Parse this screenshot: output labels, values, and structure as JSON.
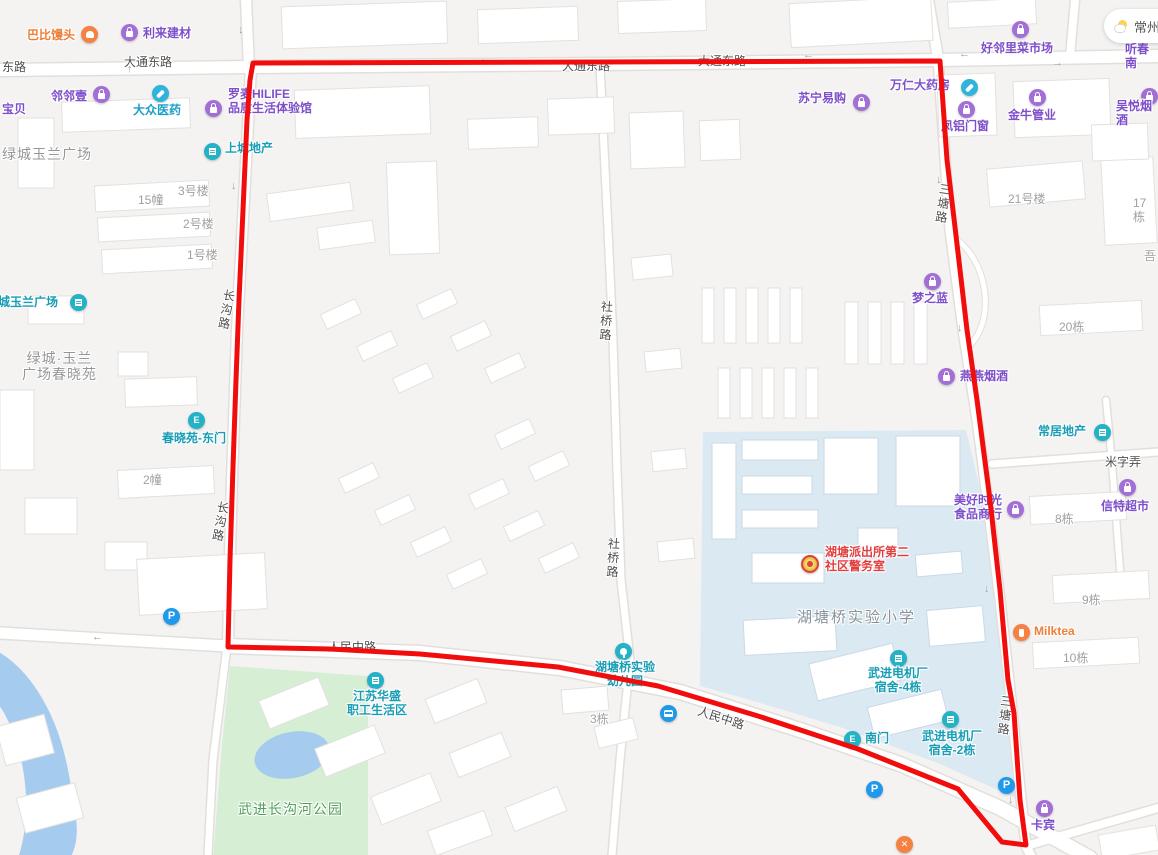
{
  "map": {
    "weather": {
      "city": "常州",
      "icon": "partly-sunny-icon"
    },
    "selection": {
      "color": "#f20d0d",
      "width": 5,
      "points": "253,63 940,61 947,160 955,227 962,287 967,330 977,400 990,500 1000,590 1008,680 1014,713 1020,800 1026,845 1002,842 958,789 858,749 758,716 658,686 558,667 420,654 330,649 228,647 230,560 233,467 236,380 239,300 243,210 247,120 250,80 253,63"
    },
    "road_labels": [
      {
        "text": "东路",
        "x": 2,
        "y": 61
      },
      {
        "text": "大通东路",
        "x": 124,
        "y": 56
      },
      {
        "text": "大通东路",
        "x": 562,
        "y": 60
      },
      {
        "text": "大通东路",
        "x": 698,
        "y": 55
      },
      {
        "text": "长沟路",
        "x": 222,
        "y": 288,
        "vertical": true,
        "rotate": 10
      },
      {
        "text": "长沟路",
        "x": 216,
        "y": 500,
        "vertical": true,
        "rotate": 10
      },
      {
        "text": "社桥路",
        "x": 599,
        "y": 300,
        "vertical": true,
        "rotate": 3
      },
      {
        "text": "社桥路",
        "x": 606,
        "y": 537,
        "vertical": true,
        "rotate": 3
      },
      {
        "text": "三塘路",
        "x": 938,
        "y": 182,
        "vertical": true,
        "rotate": 8
      },
      {
        "text": "三塘路",
        "x": 999,
        "y": 694,
        "vertical": true,
        "rotate": 6
      },
      {
        "text": "人民中路",
        "x": 328,
        "y": 641
      },
      {
        "text": "人民中路",
        "x": 700,
        "y": 705,
        "rotate": 18
      },
      {
        "text": "米字弄",
        "x": 1105,
        "y": 456
      }
    ],
    "unit_labels": [
      {
        "text": "15幢",
        "x": 138,
        "y": 194
      },
      {
        "text": "3号楼",
        "x": 178,
        "y": 185
      },
      {
        "text": "2号楼",
        "x": 183,
        "y": 218
      },
      {
        "text": "1号楼",
        "x": 187,
        "y": 249
      },
      {
        "text": "2幢",
        "x": 143,
        "y": 474
      },
      {
        "text": "3栋",
        "x": 590,
        "y": 713
      },
      {
        "text": "21号楼",
        "x": 1008,
        "y": 193
      },
      {
        "text": "17栋",
        "x": 1133,
        "y": 197
      },
      {
        "text": "吾",
        "x": 1144,
        "y": 250
      },
      {
        "text": "20栋",
        "x": 1059,
        "y": 321
      },
      {
        "text": "8栋",
        "x": 1055,
        "y": 513
      },
      {
        "text": "9栋",
        "x": 1082,
        "y": 594
      },
      {
        "text": "10栋",
        "x": 1063,
        "y": 652
      }
    ],
    "area_labels": [
      {
        "text": "绿城玉兰广场",
        "x": 2,
        "y": 146,
        "cls": "aoi"
      },
      {
        "text": "绿城·玉兰\n广场春晓苑",
        "x": 22,
        "y": 350,
        "cls": "aoi"
      },
      {
        "text": "湖塘桥实验小学",
        "x": 797,
        "y": 609,
        "cls": "school-name"
      },
      {
        "text": "武进长沟河公园",
        "x": 238,
        "y": 801,
        "cls": "park-name"
      }
    ],
    "pois": [
      {
        "text": "巴比馒头",
        "x": 27,
        "y": 29,
        "color": "orange",
        "icon": {
          "type": "bun",
          "bg": "orange",
          "x": 81,
          "y": 26
        }
      },
      {
        "text": "利来建材",
        "x": 143,
        "y": 27,
        "color": "purple",
        "icon": {
          "type": "bag",
          "bg": "purple",
          "x": 121,
          "y": 24
        }
      },
      {
        "text": "宝贝",
        "x": 2,
        "y": 103,
        "color": "purple"
      },
      {
        "text": "邻邻壹",
        "x": 51,
        "y": 90,
        "color": "purple",
        "icon": {
          "type": "bag",
          "bg": "purple",
          "x": 93,
          "y": 86
        }
      },
      {
        "text": "大众医药",
        "x": 133,
        "y": 104,
        "color": "cyan",
        "icon": {
          "type": "pill",
          "bg": "cyan",
          "x": 152,
          "y": 85
        }
      },
      {
        "text": "罗麦HILIFE\n品质生活体验馆",
        "x": 228,
        "y": 88,
        "color": "purple",
        "icon": {
          "type": "bag",
          "bg": "purple",
          "x": 205,
          "y": 100
        }
      },
      {
        "text": "上城地产",
        "x": 225,
        "y": 142,
        "color": "teal",
        "icon": {
          "type": "bldg",
          "bg": "teal",
          "x": 204,
          "y": 143
        }
      },
      {
        "text": "绿城玉兰广场",
        "x": -14,
        "y": 296,
        "color": "teal",
        "icon": {
          "type": "bldg",
          "bg": "teal",
          "x": 70,
          "y": 294
        }
      },
      {
        "text": "春晓苑-东门",
        "x": 162,
        "y": 432,
        "color": "teal",
        "icon": {
          "type": "door",
          "bg": "teal",
          "x": 188,
          "y": 412
        }
      },
      {
        "text": "苏宁易购",
        "x": 798,
        "y": 92,
        "color": "purple",
        "icon": {
          "type": "bag",
          "bg": "purple",
          "x": 853,
          "y": 94
        }
      },
      {
        "text": "万仁大药房",
        "x": 890,
        "y": 79,
        "color": "purple",
        "icon": {
          "type": "pill",
          "bg": "cyan",
          "x": 961,
          "y": 79
        }
      },
      {
        "text": "凤铝门窗",
        "x": 941,
        "y": 120,
        "color": "purple",
        "icon": {
          "type": "bag",
          "bg": "purple",
          "x": 958,
          "y": 101
        }
      },
      {
        "text": "金牛管业",
        "x": 1008,
        "y": 109,
        "color": "purple",
        "icon": {
          "type": "bag",
          "bg": "purple",
          "x": 1029,
          "y": 89
        }
      },
      {
        "text": "好邻里菜市场",
        "x": 981,
        "y": 42,
        "color": "purple",
        "icon": {
          "type": "bag",
          "bg": "purple",
          "x": 1012,
          "y": 21
        }
      },
      {
        "text": "吴悦烟酒",
        "x": 1116,
        "y": 100,
        "color": "purple",
        "icon": {
          "type": "bag",
          "bg": "purple",
          "x": 1141,
          "y": 88
        }
      },
      {
        "text": "听春南",
        "x": 1125,
        "y": 43,
        "color": "purple"
      },
      {
        "text": "梦之蓝",
        "x": 912,
        "y": 292,
        "color": "purple",
        "icon": {
          "type": "bag",
          "bg": "purple",
          "x": 924,
          "y": 273
        }
      },
      {
        "text": "燕燕烟酒",
        "x": 960,
        "y": 370,
        "color": "purple",
        "icon": {
          "type": "bag",
          "bg": "purple",
          "x": 938,
          "y": 368
        }
      },
      {
        "text": "常居地产",
        "x": 1038,
        "y": 425,
        "color": "teal",
        "icon": {
          "type": "bldg",
          "bg": "teal",
          "x": 1094,
          "y": 424
        }
      },
      {
        "text": "信特超市",
        "x": 1101,
        "y": 500,
        "color": "purple",
        "icon": {
          "type": "bag",
          "bg": "purple",
          "x": 1119,
          "y": 479
        }
      },
      {
        "text": "美好时光\n食品商行",
        "x": 950,
        "y": 494,
        "w": 56,
        "center": true,
        "color": "purple",
        "icon": {
          "type": "bag",
          "bg": "purple",
          "x": 1007,
          "y": 501
        }
      },
      {
        "text": "Milktea",
        "x": 1034,
        "y": 625,
        "color": "orange",
        "icon": {
          "type": "cup",
          "bg": "orange",
          "x": 1013,
          "y": 624
        }
      },
      {
        "text": "卡宾",
        "x": 1031,
        "y": 819,
        "color": "purple",
        "icon": {
          "type": "bag",
          "bg": "purple",
          "x": 1036,
          "y": 800
        }
      },
      {
        "text": "湖塘派出所第二\n社区警务室",
        "x": 825,
        "y": 546,
        "color": "red",
        "icon": {
          "type": "badge",
          "bg": "police",
          "x": 801,
          "y": 555
        }
      },
      {
        "text": "湖塘桥实验\n幼儿园",
        "x": 590,
        "y": 661,
        "w": 70,
        "center": true,
        "color": "teal",
        "icon": {
          "type": "tree",
          "bg": "teal",
          "x": 615,
          "y": 643
        }
      },
      {
        "text": "江苏华盛\n职工生活区",
        "x": 342,
        "y": 690,
        "w": 70,
        "center": true,
        "color": "teal",
        "icon": {
          "type": "bldg",
          "bg": "teal",
          "x": 367,
          "y": 672
        }
      },
      {
        "text": "南门",
        "x": 865,
        "y": 732,
        "color": "teal",
        "icon": {
          "type": "door",
          "bg": "teal",
          "x": 844,
          "y": 731
        }
      },
      {
        "text": "武进电机厂\n宿舍-4栋",
        "x": 860,
        "y": 667,
        "w": 76,
        "center": true,
        "color": "teal",
        "icon": {
          "type": "bldg",
          "bg": "teal",
          "x": 890,
          "y": 650
        }
      },
      {
        "text": "武进电机厂\n宿舍-2栋",
        "x": 914,
        "y": 730,
        "w": 76,
        "center": true,
        "color": "teal",
        "icon": {
          "type": "bldg",
          "bg": "teal",
          "x": 942,
          "y": 711
        }
      },
      {
        "text": "",
        "x": 0,
        "y": 0,
        "color": "teal",
        "name": "parking",
        "icon": {
          "type": "P",
          "bg": "blue",
          "x": 163,
          "y": 608
        }
      },
      {
        "text": "",
        "x": 0,
        "y": 0,
        "color": "teal",
        "name": "parking",
        "icon": {
          "type": "P",
          "bg": "blue",
          "x": 866,
          "y": 781
        }
      },
      {
        "text": "",
        "x": 0,
        "y": 0,
        "color": "teal",
        "name": "parking",
        "icon": {
          "type": "P",
          "bg": "blue",
          "x": 998,
          "y": 777
        }
      },
      {
        "text": "",
        "x": 0,
        "y": 0,
        "color": "teal",
        "name": "bus-stop",
        "icon": {
          "type": "bus",
          "bg": "blue",
          "x": 660,
          "y": 705
        }
      },
      {
        "text": "",
        "x": 0,
        "y": 0,
        "color": "orange",
        "name": "restaurant",
        "icon": {
          "type": "cross",
          "bg": "orange",
          "x": 896,
          "y": 836
        }
      }
    ],
    "arrows": [
      {
        "d": "down",
        "x": 238,
        "y": 24
      },
      {
        "d": "up",
        "x": 127,
        "y": 63
      },
      {
        "d": "left",
        "x": 480,
        "y": 53
      },
      {
        "d": "left",
        "x": 803,
        "y": 49
      },
      {
        "d": "left",
        "x": 959,
        "y": 48
      },
      {
        "d": "right",
        "x": 1052,
        "y": 57
      },
      {
        "d": "down",
        "x": 231,
        "y": 180
      },
      {
        "d": "down",
        "x": 936,
        "y": 174
      },
      {
        "d": "down",
        "x": 957,
        "y": 322
      },
      {
        "d": "down",
        "x": 984,
        "y": 583
      },
      {
        "d": "up",
        "x": 999,
        "y": 600
      },
      {
        "d": "down",
        "x": 1008,
        "y": 794
      },
      {
        "d": "left",
        "x": 92,
        "y": 631
      },
      {
        "d": "left",
        "x": 271,
        "y": 639
      }
    ]
  }
}
